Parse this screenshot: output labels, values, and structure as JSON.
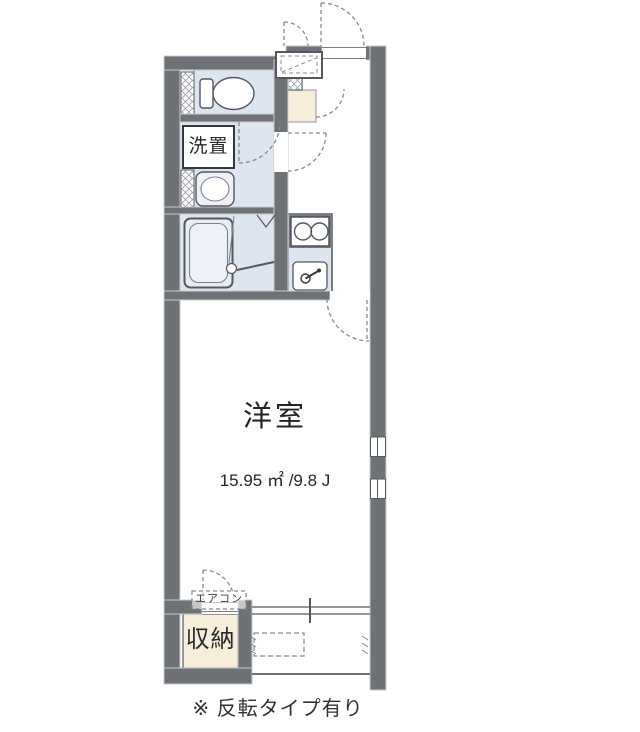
{
  "floorplan": {
    "labels": {
      "laundry": "洗置",
      "room": "洋室",
      "area": "15.95 ㎡ /9.8 J",
      "aircon": "エアコン",
      "storage": "収納",
      "note": "※ 反転タイプ有り"
    },
    "colors": {
      "wall": "#6e7176",
      "wall_edge": "#c9cbce",
      "room_blue": "#dde5ef",
      "fixture_fill": "#eef2f8",
      "entrance_beige": "#f6eed9",
      "storage_beige": "#f6eed9",
      "line_dark": "#55585e",
      "dash_gray": "#85888d"
    }
  }
}
